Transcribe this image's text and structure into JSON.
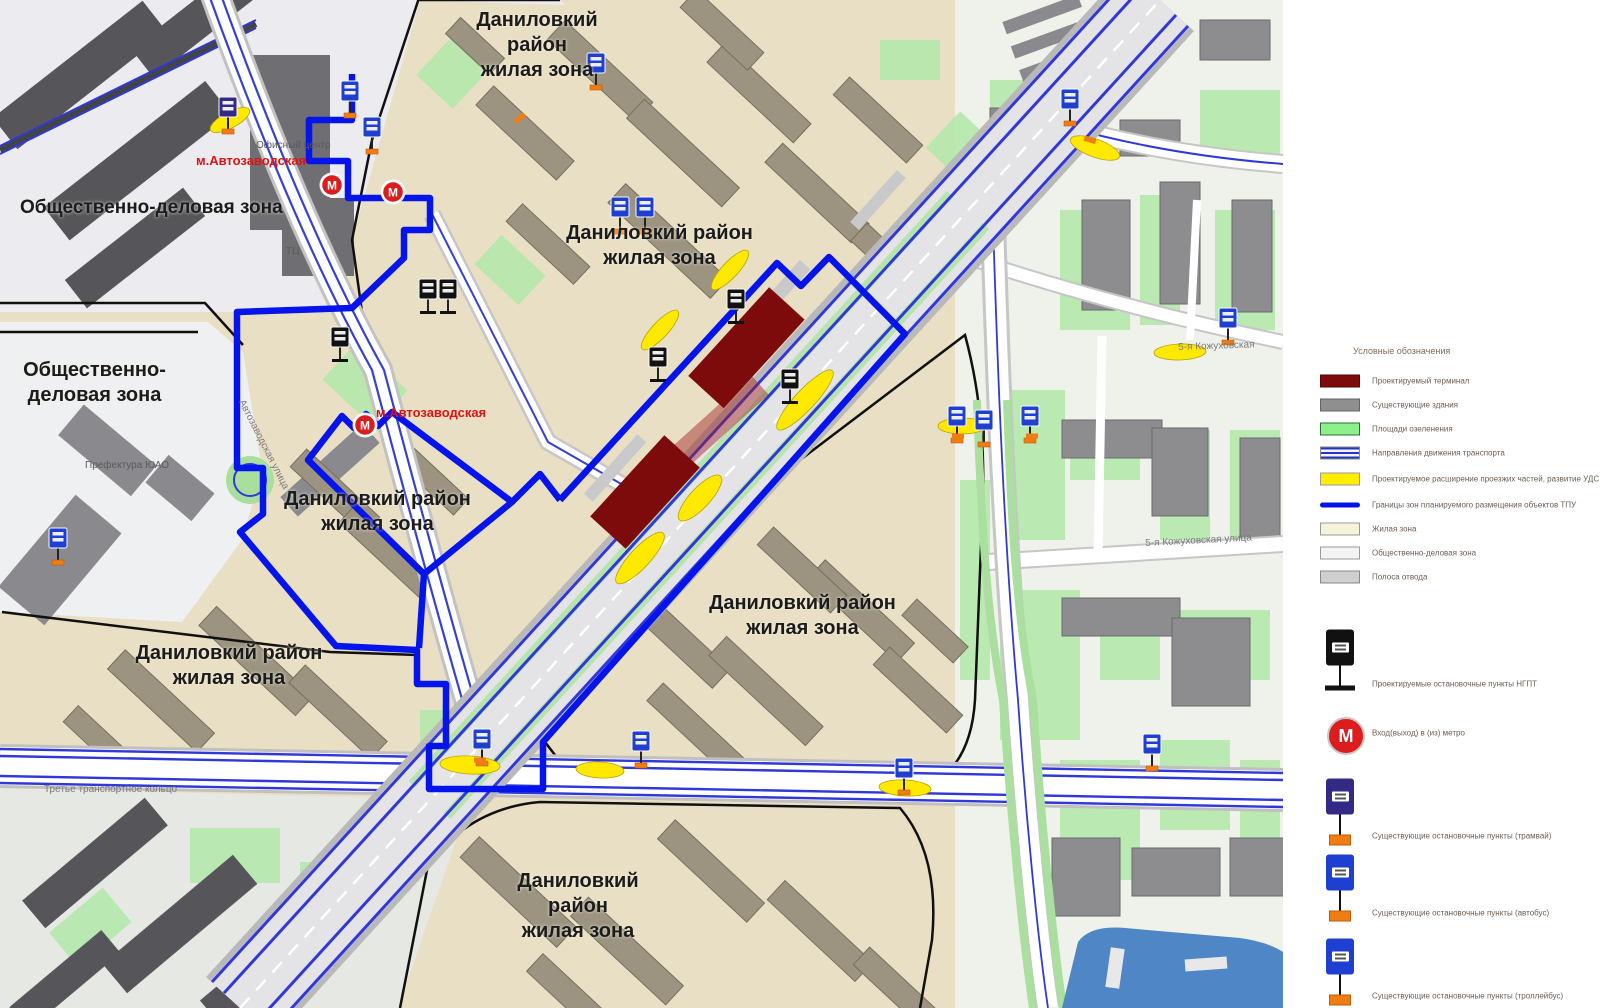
{
  "map": {
    "labels": [
      {
        "text": "Общественно-деловая зона",
        "x": 20,
        "y": 196,
        "cls": "zone-left"
      },
      {
        "text": "Общественно-\nделовая зона",
        "x": 12,
        "y": 358,
        "cls": "zone",
        "w": 165
      },
      {
        "text": "Даниловкий район\nжилая зона",
        "x": 447,
        "y": 8,
        "cls": "zone",
        "w": 180
      },
      {
        "text": "Даниловкий район\nжилая зона",
        "x": 562,
        "y": 221,
        "cls": "zone",
        "w": 195
      },
      {
        "text": "Даниловкий район\nжилая зона",
        "x": 280,
        "y": 487,
        "cls": "zone",
        "w": 195
      },
      {
        "text": "Даниловкий район\nжилая зона",
        "x": 133,
        "y": 641,
        "cls": "zone",
        "w": 192
      },
      {
        "text": "Даниловкий район\nжилая зона",
        "x": 705,
        "y": 591,
        "cls": "zone",
        "w": 195
      },
      {
        "text": "Даниловкий район\nжилая зона",
        "x": 488,
        "y": 869,
        "cls": "zone",
        "w": 180
      },
      {
        "text": "м.Автозаводская",
        "x": 196,
        "y": 153,
        "cls": "metro-name"
      },
      {
        "text": "м.Автозаводская",
        "x": 376,
        "y": 405,
        "cls": "metro-name"
      },
      {
        "text": "Офисный центр",
        "x": 256,
        "y": 140,
        "cls": "poi"
      },
      {
        "text": "ТЦ",
        "x": 286,
        "y": 246,
        "cls": "poi"
      },
      {
        "text": "Префектура ЮАО",
        "x": 85,
        "y": 460,
        "cls": "poi"
      },
      {
        "text": "Третье транспортное кольцо",
        "x": 44,
        "y": 784,
        "cls": "street"
      },
      {
        "text": "5-я Кожуховская",
        "x": 1178,
        "y": 342,
        "cls": "street",
        "rot": -2
      },
      {
        "text": "5-я Кожуховская улица",
        "x": 1145,
        "y": 538,
        "cls": "street",
        "rot": -3
      },
      {
        "text": "Автозаводская улица",
        "x": 246,
        "y": 398,
        "cls": "street",
        "rot": 63
      }
    ]
  },
  "icons": {
    "metro_letter": "М",
    "metro_name": "metro-entrance-icon",
    "bus_existing_name": "bus-stop-icon",
    "tram_existing_name": "tram-stop-icon",
    "ngpt_projected_name": "projected-ngpt-stop-icon"
  },
  "colors": {
    "terminal": "#7d0b0b",
    "tpu_boundary": "#0514ea",
    "road_widening": "#ffee00",
    "metro_red": "#dd1d1d",
    "stop_blue": "#1e3fd0",
    "stop_tram": "#322a85",
    "stop_black": "#111111",
    "residential_zone": "#e9dfc4",
    "odz_zone": "#ececf0",
    "green_area": "#b5e8ac",
    "water": "#4e86c6"
  },
  "legend": {
    "title": "Условные обозначения",
    "items": [
      {
        "swatch": "terminal",
        "label": "Проектируемый терминал"
      },
      {
        "swatch": "building",
        "label": "Существующие здания"
      },
      {
        "swatch": "green",
        "label": "Площади озеленения"
      },
      {
        "swatch": "traffic",
        "label": "Направления движения транспорта"
      },
      {
        "swatch": "widening",
        "label": "Проектируемое расширение проезжих частей, развитие УДС"
      },
      {
        "swatch": "boundary",
        "label": "Границы зон планируемого размещения объектов ТПУ"
      },
      {
        "swatch": "residential",
        "label": "Жилая зона"
      },
      {
        "swatch": "odz",
        "label": "Общественно-деловая зона"
      },
      {
        "swatch": "row",
        "label": "Полоса отвода"
      }
    ],
    "stops": [
      {
        "type": "ngpt",
        "label": "Проектируемые остановочные пункты НГПТ"
      },
      {
        "type": "metro",
        "label": "Вход(выход) в (из) метро"
      },
      {
        "type": "tram",
        "label": "Существующие остановочные пункты (трамвай)"
      },
      {
        "type": "bus",
        "label": "Существующие остановочные пункты (автобус)"
      },
      {
        "type": "trolleybus",
        "label": "Существующие остановочные пункты (троллейбус)"
      }
    ]
  }
}
